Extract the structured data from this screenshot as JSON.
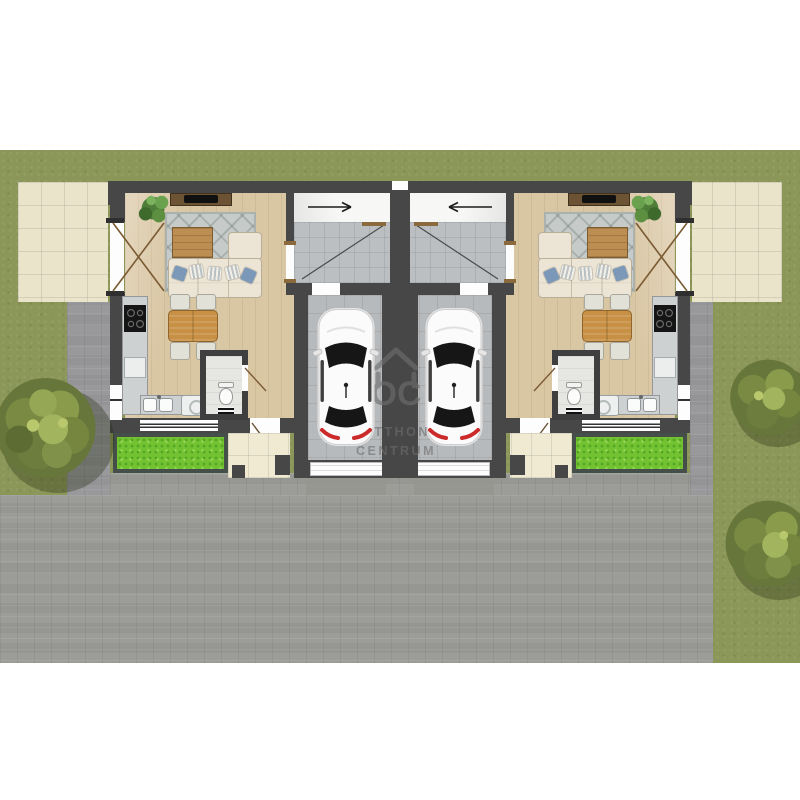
{
  "watermark": {
    "monogram": "OC",
    "line1": "OTTHON",
    "line2": "CENTRUM"
  },
  "scene": {
    "type": "duplex-floor-plan",
    "units": 2,
    "cars": 2,
    "trees": 3,
    "entrance_arrows": [
      "right",
      "left"
    ]
  },
  "colors": {
    "page-bg": "#ffffff",
    "lawn": "#8b9758",
    "driveway": "#9c9c98",
    "path": "#99999b",
    "patio": "#eae4cb",
    "walkway": "#f0ead3",
    "garden": "#72c232",
    "wall": "#474747",
    "wood-floor": "#d9c6a3",
    "tile-floor": "#bcbfc1",
    "garage-floor": "#b7babc",
    "wc-floor": "#e6e7e3",
    "counter": "#ced1d2",
    "cooktop": "#151515",
    "table-wood": "#c79045",
    "sofa": "#ece4d4",
    "rug": "#c6cbc9",
    "pillow-blue": "#7b98b8",
    "car-body": "#fbfbfb",
    "car-glass": "#161616",
    "taillight": "#cc2a2a",
    "door-wood": "#8a6a3c",
    "tree-dark": "#67763a",
    "tree-mid": "#7a8a42",
    "tree-light": "#a2b45e",
    "watermark": "#6e6e6e",
    "arrow": "#1c1c1c"
  }
}
